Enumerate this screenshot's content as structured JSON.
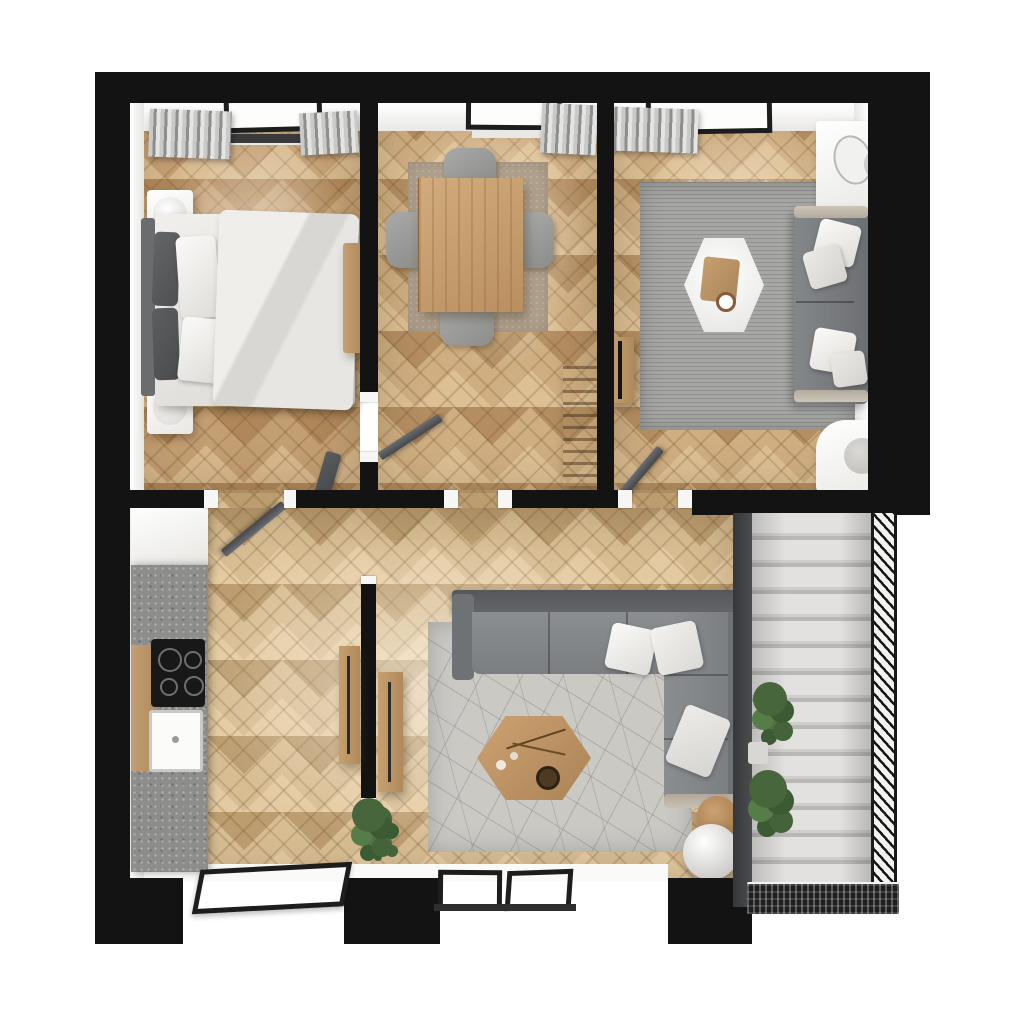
{
  "scene": {
    "type": "apartment-floor-plan-top-down-render",
    "background": "#ffffff",
    "palette": {
      "wall": "#131313",
      "wall_face": "#f6f6f4",
      "floor_warm": "#cfae82",
      "floor_pale": "#d8bd93",
      "rug_dining": "#b3a491",
      "rug_living": "#a7a7a5",
      "rug_lounge": "#cac9c4",
      "sofa_grey": "#85888b",
      "sofa_dark": "#5e6063",
      "wood_furniture": "#bf9565",
      "counter_grey": "#8d8d8b",
      "cooktop_black": "#181818",
      "stair_step": "#dedddb",
      "stair_rail": "#1a1a1a",
      "plant_green": "#47663b",
      "white_furniture": "#f4f3f0",
      "window_frame": "#1d1d1d"
    },
    "rooms": [
      {
        "id": "bedroom",
        "position": "top-left",
        "floor": "herringbone-oak"
      },
      {
        "id": "dining-room",
        "position": "top-center",
        "floor": "herringbone-oak"
      },
      {
        "id": "living-room",
        "position": "top-right",
        "floor": "herringbone-oak"
      },
      {
        "id": "kitchen",
        "position": "bottom-left",
        "floor": "herringbone-oak"
      },
      {
        "id": "lounge",
        "position": "bottom-center",
        "floor": "herringbone-oak"
      },
      {
        "id": "staircase",
        "position": "bottom-right",
        "floor": "stone-steps"
      }
    ],
    "furniture": [
      "double-bed",
      "headboard",
      "nightstand",
      "nightstand",
      "bench",
      "dining-table",
      "dining-chair",
      "dining-chair",
      "dining-chair",
      "dining-chair",
      "sofa-two-seater",
      "hexagonal-coffee-table",
      "white-side-cabinet",
      "white-armchair",
      "tv-sideboard",
      "decor-ladder",
      "kitchen-tall-cabinet",
      "kitchen-counter",
      "cooktop",
      "sink",
      "partition-sideboard",
      "partition-sideboard",
      "sectional-sofa",
      "hexagonal-wood-table",
      "wood-pouf",
      "white-sphere-pouf",
      "floor-plant",
      "stair-plants",
      "window",
      "window",
      "window",
      "window",
      "window",
      "window",
      "door-leaf",
      "door-leaf",
      "door-leaf",
      "door-leaf"
    ]
  }
}
